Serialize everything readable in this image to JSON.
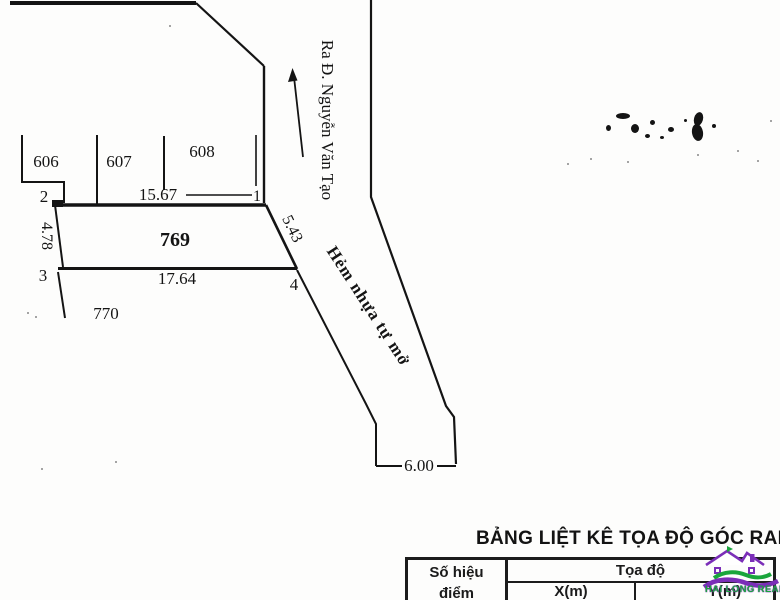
{
  "map": {
    "street_direction_label": "Ra Đ. Nguyễn Văn Tạo",
    "alley_label": "Hẻm nhựa tự mở",
    "parcels": {
      "p606": "606",
      "p607": "607",
      "p608": "608",
      "p769": "769",
      "p770": "770"
    },
    "corners": {
      "c1": "1",
      "c2": "2",
      "c3": "3",
      "c4": "4"
    },
    "dimensions": {
      "top": "15.67",
      "bottom": "17.64",
      "left": "4.78",
      "right": "5.43",
      "alley_width": "6.00"
    }
  },
  "coordinate_table": {
    "title": "BẢNG LIỆT KÊ TỌA ĐỘ GÓC RANH",
    "point_header_line1": "Số hiệu",
    "point_header_line2": "điểm",
    "coord_header": "Tọa độ",
    "x_header": "X(m)",
    "y_header": "Y(m)"
  },
  "watermark": {
    "brand": "HAI LONG REAL",
    "purple": "#7b2eb8",
    "green": "#1aa53c"
  }
}
